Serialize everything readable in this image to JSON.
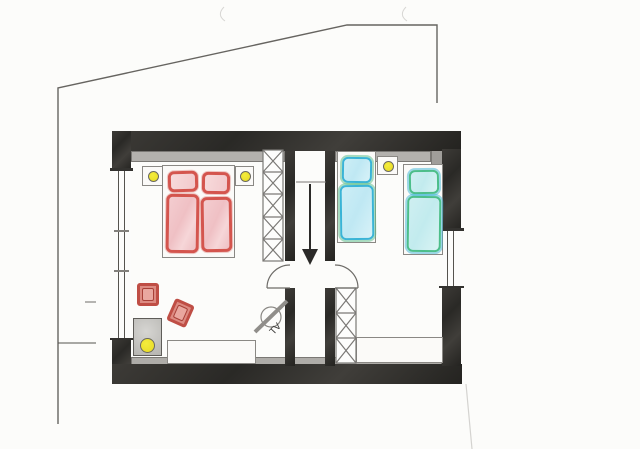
{
  "title": "Hand-drawn floor plan, upper storey with two bedrooms and stair hall",
  "labels": {
    "tv": "TV"
  },
  "colors": {
    "wall": "#2f2e2b",
    "wall_lining": "#b3b1ad",
    "pencil_outline": "#55534f",
    "double_bed_red": "#d4554e",
    "double_bed_fill": "#f2c8cb",
    "single_bed_blue": "#3ab4d6",
    "single_bed_green": "#4cbe8a",
    "single_bed_fill": "#cdeef6",
    "lamp_yellow": "#ece32f",
    "cushion_red": "#bf4e45",
    "paper": "#fcfcfa"
  },
  "rooms": {
    "left_bedroom": {
      "name": "master bedroom",
      "items": [
        "double bed with red bedding (two pillows, two duvets)",
        "nightstand with lamp, left of bed",
        "nightstand with lamp, right of bed",
        "wardrobe with five sections (X symbols)",
        "red seat cushion",
        "red seat cushion, rotated",
        "table with lamp in lower-left corner",
        "sideboard along bottom wall",
        "wall-mounted TV symbol"
      ]
    },
    "stair_hall": {
      "name": "stairwell corridor",
      "items": [
        "stairs going down (arrow pointing down)",
        "stair break line",
        "door swinging into left bedroom",
        "door swinging into right bedroom"
      ]
    },
    "right_bedroom": {
      "name": "twin bedroom",
      "items": [
        "single bed with blue/green bedding near hall",
        "single bed with green/blue bedding near window",
        "nightstand with lamp between beds",
        "wardrobe with three sections (X symbols)",
        "desk/sideboard along bottom wall"
      ]
    }
  },
  "architecture": {
    "windows": [
      "large window on left wall",
      "window on right wall"
    ],
    "outline": "pencil outline of the building footprint above and left of the plan"
  }
}
